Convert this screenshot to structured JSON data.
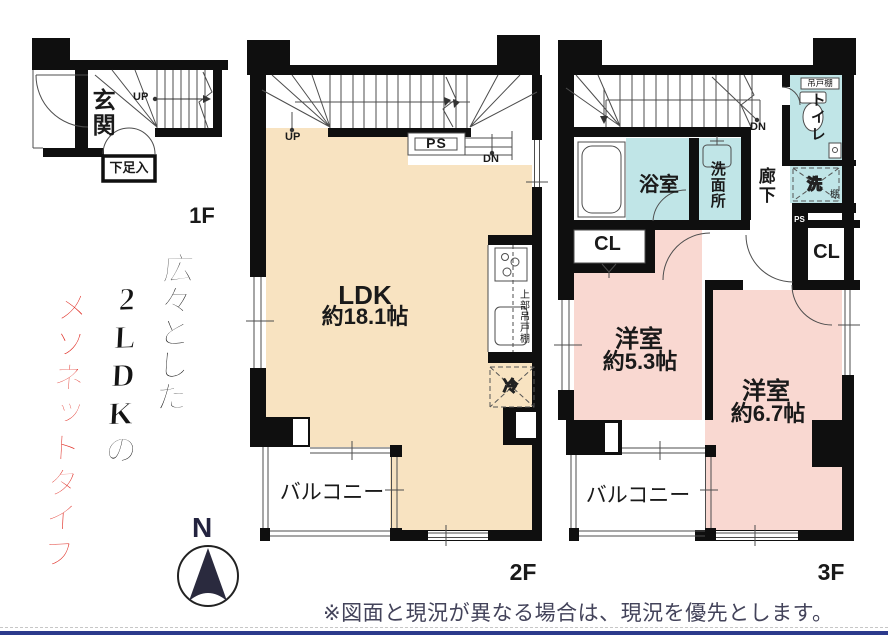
{
  "slogan": {
    "line1": "広々とした",
    "line2": "2LDKの",
    "line3": "メゾネットタイプ",
    "accent_color": "#df2b22"
  },
  "floor1": {
    "label": "1F",
    "entrance": "玄関",
    "shoe_box": "下足入",
    "up": "UP"
  },
  "floor2": {
    "label": "2F",
    "room": "LDK",
    "room_size": "約18.1帖",
    "pipe_space": "PS",
    "up": "UP",
    "down": "DN",
    "upper_cabinet": "上部吊戸棚",
    "fridge": "冷",
    "balcony": "バルコニー"
  },
  "floor3": {
    "label": "3F",
    "down": "DN",
    "bathroom": "浴室",
    "washroom": "洗面所",
    "corridor": "廊下",
    "toilet": "トイレ",
    "hanging_cabinet": "吊戸棚",
    "washer": "洗",
    "shelf": "棚",
    "pipe_space": "PS",
    "closet1": "CL",
    "closet2": "CL",
    "room1": "洋室",
    "room1_size": "約5.3帖",
    "room2": "洋室",
    "room2_size": "約6.7帖",
    "balcony": "バルコニー"
  },
  "compass": {
    "north": "N"
  },
  "footer": {
    "note": "※図面と現況が異なる場合は、現況を優先とします。",
    "line_color": "#2c3a8c"
  },
  "palette": {
    "ldk": "#f8e3c1",
    "bedroom": "#f9d8d1",
    "wet_area": "#c0e5e7",
    "wall": "#0f0f0f"
  }
}
